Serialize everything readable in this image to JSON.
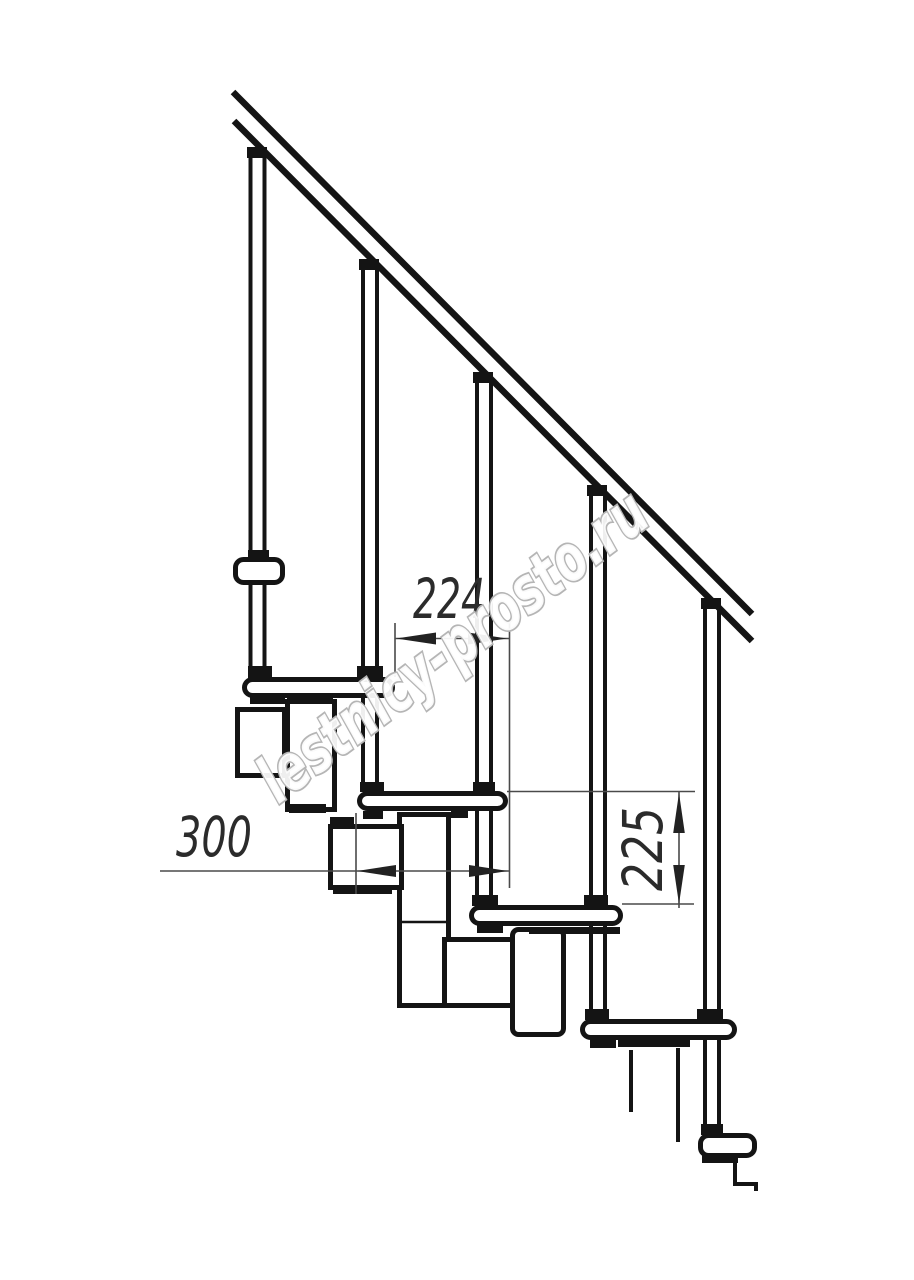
{
  "drawing": {
    "title": "Modular staircase side-view technical drawing",
    "background": "#ffffff",
    "ink_color": "#141414",
    "dimension_line_color": "#4a4a4a"
  },
  "dimensions": {
    "run": {
      "value": "224",
      "orientation": "horizontal",
      "meaning": "step run between tread edges"
    },
    "depth": {
      "value": "300",
      "orientation": "horizontal",
      "meaning": "tread depth"
    },
    "rise": {
      "value": "225",
      "orientation": "vertical",
      "meaning": "step height"
    }
  },
  "watermark": {
    "text": "lestnicy-prosto.ru",
    "color": "#b5b5b5"
  }
}
